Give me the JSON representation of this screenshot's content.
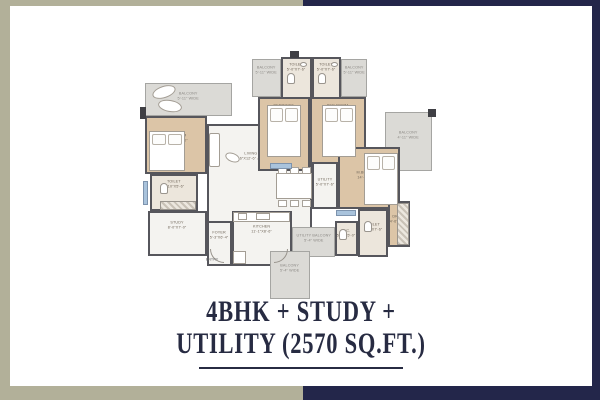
{
  "title": {
    "line1": "4BHK + STUDY +",
    "line2": "UTILITY (2570 SQ.FT.)"
  },
  "colors": {
    "frame_left": "#b2b099",
    "frame_right": "#23264a",
    "card": "#ffffff",
    "wall": "#56565c",
    "room_tan": "#dcc5a7",
    "room_white": "#f4f3f0",
    "room_bath": "#ece6dc",
    "balcony": "#dbdad6",
    "window": "#a9c3dc",
    "title": "#272b42",
    "label": "#6f6558",
    "balcony_label": "#8b8884"
  },
  "floorplan": {
    "entry_label": "ENTRY",
    "rooms": [
      {
        "id": "balcony-top-left",
        "label": "BALCONY",
        "dims": "5'-11\" WIDE",
        "type": "balcony",
        "x": 112,
        "y": 8,
        "w": 29,
        "h": 38,
        "lt": 6
      },
      {
        "id": "toilet-top-left",
        "label": "TOILET",
        "dims": "5'-0\"X7'-6\"",
        "type": "bath",
        "x": 141,
        "y": 6,
        "w": 31,
        "h": 42,
        "lt": 4
      },
      {
        "id": "toilet-top-right",
        "label": "TOILET",
        "dims": "5'-0\"X7'-6\"",
        "type": "bath",
        "x": 172,
        "y": 6,
        "w": 29,
        "h": 42,
        "lt": 4
      },
      {
        "id": "balcony-top-right",
        "label": "BALCONY",
        "dims": "5'-11\" WIDE",
        "type": "balcony",
        "x": 201,
        "y": 8,
        "w": 26,
        "h": 38,
        "lt": 6
      },
      {
        "id": "balcony-left",
        "label": "BALCONY",
        "dims": "5'-11\" WIDE",
        "type": "balcony",
        "x": 5,
        "y": 32,
        "w": 87,
        "h": 33,
        "lt": 8
      },
      {
        "id": "balcony-right",
        "label": "BALCONY",
        "dims": "4'-11\" WIDE",
        "type": "balcony",
        "x": 245,
        "y": 61,
        "w": 47,
        "h": 59,
        "lt": 18
      },
      {
        "id": "living-dining",
        "label": "LIVING / DINING",
        "dims": "20'-6\"X12'-6\" & 10'-11\"X11'-6\"",
        "type": "white",
        "x": 67,
        "y": 73,
        "w": 105,
        "h": 110,
        "lt": 26
      },
      {
        "id": "bedroom-2",
        "label": "BEDROOM",
        "dims": "10'-0\"X12'-0\"",
        "type": "tan",
        "x": 118,
        "y": 46,
        "w": 52,
        "h": 74,
        "lt": 5
      },
      {
        "id": "bedroom-3",
        "label": "BED ROOM",
        "dims": "12'-0\"X10'-6\"",
        "type": "tan",
        "x": 170,
        "y": 46,
        "w": 56,
        "h": 74,
        "lt": 5
      },
      {
        "id": "bedroom-1",
        "label": "BEDROOM",
        "dims": "11'-0\"X10'-0\"",
        "type": "tan",
        "x": 5,
        "y": 65,
        "w": 62,
        "h": 58,
        "lt": 16
      },
      {
        "id": "m-bedroom",
        "label": "M.BEDROOM",
        "dims": "14'-0\"X11'-6\"",
        "type": "tan",
        "x": 198,
        "y": 96,
        "w": 62,
        "h": 62,
        "lt": 22
      },
      {
        "id": "utility",
        "label": "UTILITY",
        "dims": "5'-0\"X7'-6\"",
        "type": "white",
        "x": 172,
        "y": 111,
        "w": 26,
        "h": 47,
        "lt": 14
      },
      {
        "id": "toilet-left",
        "label": "TOILET",
        "dims": "7'-10\"X5'-6\"",
        "type": "bath",
        "x": 10,
        "y": 123,
        "w": 48,
        "h": 37,
        "lt": 4
      },
      {
        "id": "study",
        "label": "STUDY",
        "dims": "8'-0\"X7'-0\"",
        "type": "white",
        "x": 8,
        "y": 160,
        "w": 59,
        "h": 45,
        "lt": 8
      },
      {
        "id": "foyer",
        "label": "FOYER",
        "dims": "5'-3\"X6'-4\"",
        "type": "white",
        "x": 67,
        "y": 170,
        "w": 25,
        "h": 45,
        "lt": 8
      },
      {
        "id": "kitchen",
        "label": "KITCHEN",
        "dims": "11'-1\"X8'-6\"",
        "type": "white",
        "x": 92,
        "y": 160,
        "w": 60,
        "h": 55,
        "lt": 12
      },
      {
        "id": "utility-balcony",
        "label": "UTILITY BALCONY",
        "dims": "5'-4\" WIDE",
        "type": "balcony",
        "x": 152,
        "y": 176,
        "w": 43,
        "h": 30,
        "lt": 6
      },
      {
        "id": "wc",
        "label": "W.C.",
        "dims": "5'-0\"X5'-0\"",
        "type": "bath",
        "x": 195,
        "y": 170,
        "w": 23,
        "h": 35,
        "lt": 6
      },
      {
        "id": "toilet-bottom",
        "label": "TOILET",
        "dims": "5'-0\"X7'-6\"",
        "type": "bath",
        "x": 218,
        "y": 158,
        "w": 30,
        "h": 48,
        "lt": 12
      },
      {
        "id": "dress",
        "label": "DRESS",
        "dims": "4'-6\"X7'-6\"",
        "type": "tan",
        "x": 248,
        "y": 150,
        "w": 22,
        "h": 46,
        "lt": 12
      },
      {
        "id": "balcony-bottom",
        "label": "BALCONY",
        "dims": "5'-4\" WIDE",
        "type": "balcony",
        "x": 130,
        "y": 200,
        "w": 40,
        "h": 48,
        "lt": 12
      }
    ]
  }
}
